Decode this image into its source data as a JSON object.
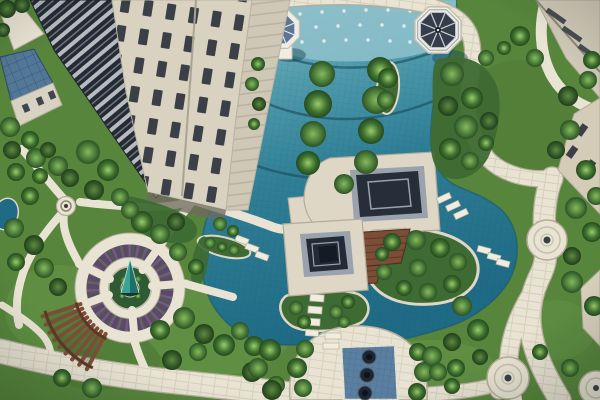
{
  "scene": {
    "description": "Aerial photograph of a residential complex courtyard: turquoise ponds with fountain jets and tree planters, two dark-roofed central pavilions linked by a wooden deck, two gazebos, a circular plaza with a teal spiral sculpture and purple planting rings, a wooden pergola, winding cream stone paths with circular nodes, lawns and trees, a tall cream high-rise at upper left and beige building facades along the edges",
    "view": "top-down aerial",
    "setting": "residential garden courtyard"
  },
  "palette": {
    "grass": "#57853c",
    "grassLight": "#6b9c4a",
    "grassDark": "#476f31",
    "waterTop": "#8ec1cb",
    "waterMid": "#4f9aab",
    "water": "#2f7f96",
    "waterDeep": "#1f6a85",
    "waterEdge": "#1d4f60",
    "path": "#e9e3d3",
    "pathBorder": "#b3ac99",
    "pathStone": "#c6bfab",
    "platform": "#ded7c5",
    "roofDark": "#262e3a",
    "roofFrame": "#9aa2ae",
    "gazeboRoofBlue": "#5d7591",
    "gazeboRoofDark": "#343d49",
    "gazeboBase": "#efece2",
    "wood": "#7c4e37",
    "woodDark": "#5d3826",
    "towerWall": "#d9d2c0",
    "towerFace": "#cfc8b6",
    "windowDark": "#3a3f48",
    "glassDark": "#262b33",
    "glassStripe": "#cfd4da",
    "blueRoof": "#537796",
    "blueRoofLine": "#33517a",
    "planterPurple": "#5a4a67",
    "planterPurpleLight": "#7c6488",
    "sculptureTeal": "#2f8f86",
    "shadow": "#14404f",
    "poolBlue": "#5a7fa0",
    "bowlDark": "#1c2735",
    "treeLight": "#86b95e",
    "treeMid": "#4e7f3a",
    "treeDark": "#2c5226",
    "shrub": "#3e6a33"
  }
}
